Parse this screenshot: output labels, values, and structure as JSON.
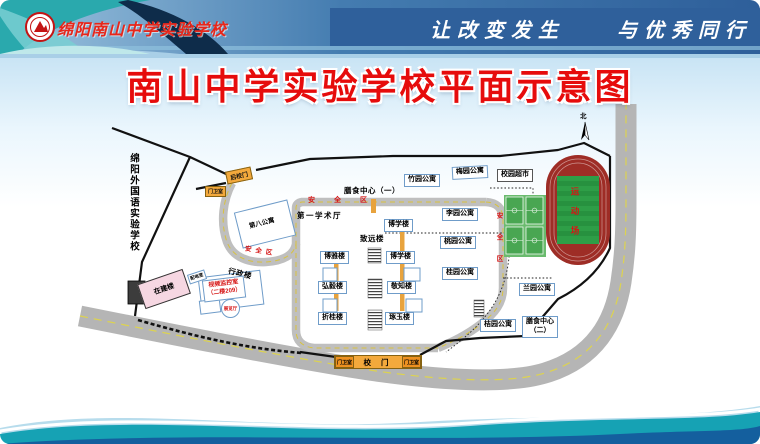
{
  "header": {
    "school_name": "绵阳南山中学实验学校",
    "slogan_left": "让改变发生",
    "slogan_right": "与优秀同行",
    "logo": "school-emblem"
  },
  "title": "南山中学实验学校平面示意图",
  "map": {
    "neighbor_school": "绵阳外国语实验学校",
    "north": "北",
    "sports_field": "运动场",
    "safety_zone": "安全区",
    "supermarket": "校园超市",
    "dining_center_1": "膳食中心（一）",
    "dining_center_2_line1": "膳食中心",
    "dining_center_2_line2": "（二）",
    "academic_hall": "第一学术厅",
    "zhiyuan_building": "致远楼",
    "admin_building": "行政楼",
    "monitor_room_line1": "视频监控室",
    "monitor_room_line2": "（二楼209）",
    "exhibition_hall": "展览厅",
    "power_room": "配电室",
    "under_construction": "在建楼",
    "back_gate": "后校门",
    "main_gate": "校 门",
    "guard_room": "门卫室",
    "apartments": [
      "第八公寓",
      "竹园公寓",
      "梅园公寓",
      "李园公寓",
      "桃园公寓",
      "桂园公寓",
      "兰园公寓",
      "桔园公寓"
    ],
    "teaching_buildings": [
      "博学楼",
      "博雅楼",
      "博学楼",
      "弘毅楼",
      "敬知楼",
      "折桂楼",
      "琢玉楼"
    ]
  },
  "colors": {
    "title_red": "#e60c0c",
    "gate_orange": "#f3a93c",
    "track_red": "#9e2d26",
    "field_green": "#2e9e47",
    "road_gray": "#b5b5b5",
    "safety_red": "#d61515",
    "header_blue": "#2f609b",
    "footer_teal": "#16a2b4"
  }
}
